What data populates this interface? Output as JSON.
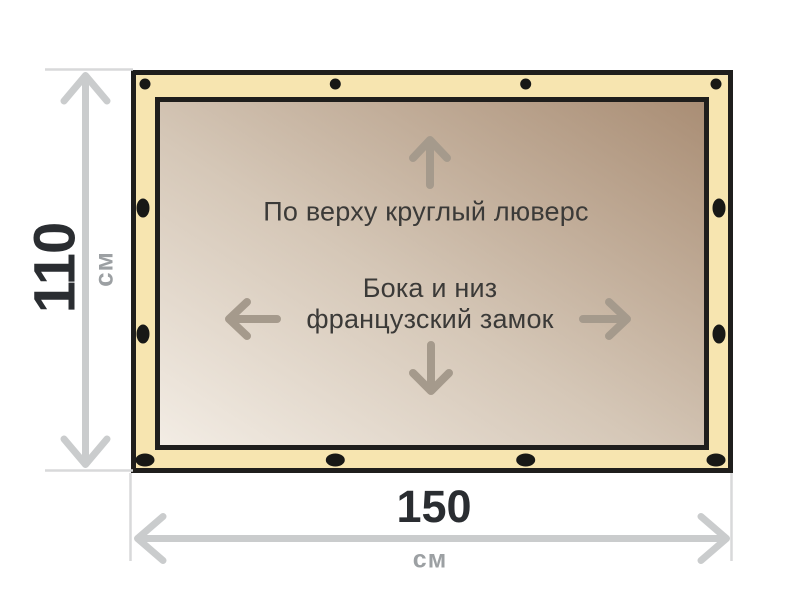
{
  "diagram": {
    "type": "tarp-dimension-diagram",
    "notes": {
      "top": "По верху круглый люверс",
      "middle_line1": "Бока и низ",
      "middle_line2": "французский замок"
    },
    "dimensions": {
      "height": {
        "value": "110",
        "unit": "см"
      },
      "width": {
        "value": "150",
        "unit": "см"
      }
    },
    "colors": {
      "background": "#ffffff",
      "tarp_fill": "#f7e5b0",
      "outline": "#1f1e1c",
      "grommet": "#181816",
      "interior_light": "#f3ede5",
      "interior_mid": "#d5c7b7",
      "interior_dark": "#a98d74",
      "interior_arrow": "#a59a8c",
      "note_text": "#3b3a38",
      "dim_line": "#cacccd",
      "dim_ext_line": "#d8d9da",
      "dim_value_text": "#2a2d31",
      "dim_unit_text": "#9ca0a3"
    }
  }
}
